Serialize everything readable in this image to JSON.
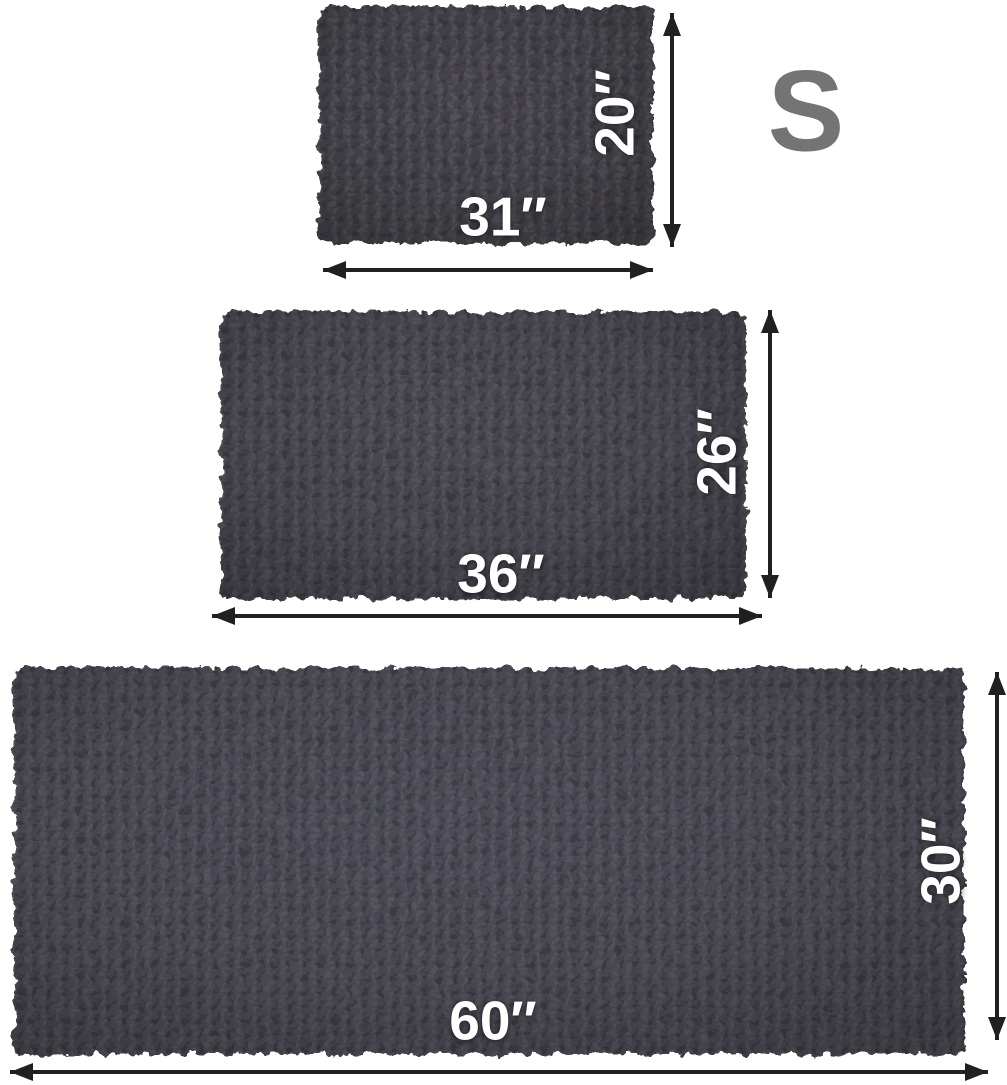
{
  "size_chart": {
    "badge_label": "S",
    "rugs": [
      {
        "size": "small",
        "width_label": "31″",
        "height_label": "20″",
        "width_in": 31,
        "height_in": 20
      },
      {
        "size": "medium",
        "width_label": "36″",
        "height_label": "26″",
        "width_in": 36,
        "height_in": 26
      },
      {
        "size": "large",
        "width_label": "60″",
        "height_label": "30″",
        "width_in": 60,
        "height_in": 30
      }
    ],
    "colors": {
      "rug_small": "#46444b",
      "rug_medium": "#4a4952",
      "rug_large": "#4d4c56",
      "arrow": "#202022",
      "dimension_text": "#ffffff",
      "badge_text": "#747477",
      "background": "#ffffff"
    }
  }
}
